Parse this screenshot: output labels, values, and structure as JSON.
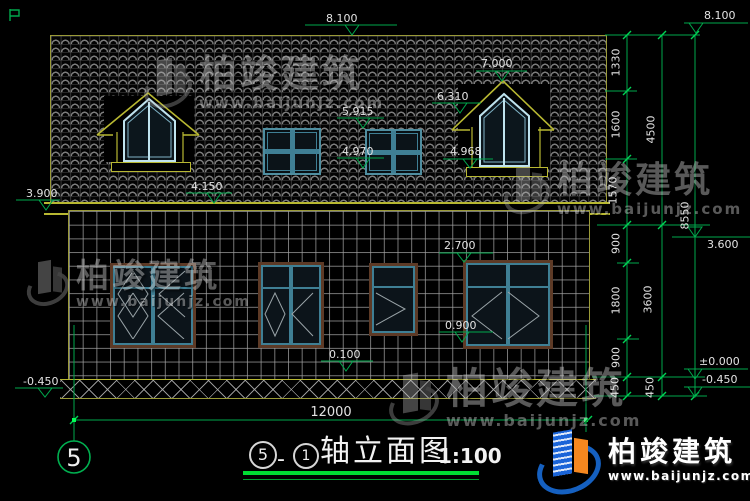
{
  "levels": {
    "ridge_top": "8.100",
    "ridge_right": "8.100",
    "dormer_peak": "7.000",
    "dormer_eave": "6.310",
    "roof_window_head": "5.915",
    "roof_window_sill": "4.970",
    "dormer_window_sill": "4.968",
    "eave_high": "4.150",
    "eave_low": "3.900",
    "floor2": "3.600",
    "window_head": "2.700",
    "window_sill": "0.900",
    "porch": "0.100",
    "zero": "±0.000",
    "ground_left": "-0.450",
    "ground_right": "-0.450"
  },
  "dims": {
    "inner": [
      "1330",
      "1600",
      "1570",
      "900",
      "1800",
      "900",
      "450"
    ],
    "mid": [
      "4500",
      "3600",
      "450"
    ],
    "total": "8550",
    "width": "12000"
  },
  "title": {
    "bubble_left": "5",
    "sep": "-",
    "bubble_right": "1",
    "name": "轴立面图",
    "scale": "1:100"
  },
  "axis": {
    "bubble": "5"
  },
  "brand": {
    "name": "柏竣建筑",
    "url": "www.baijunjz.com"
  }
}
